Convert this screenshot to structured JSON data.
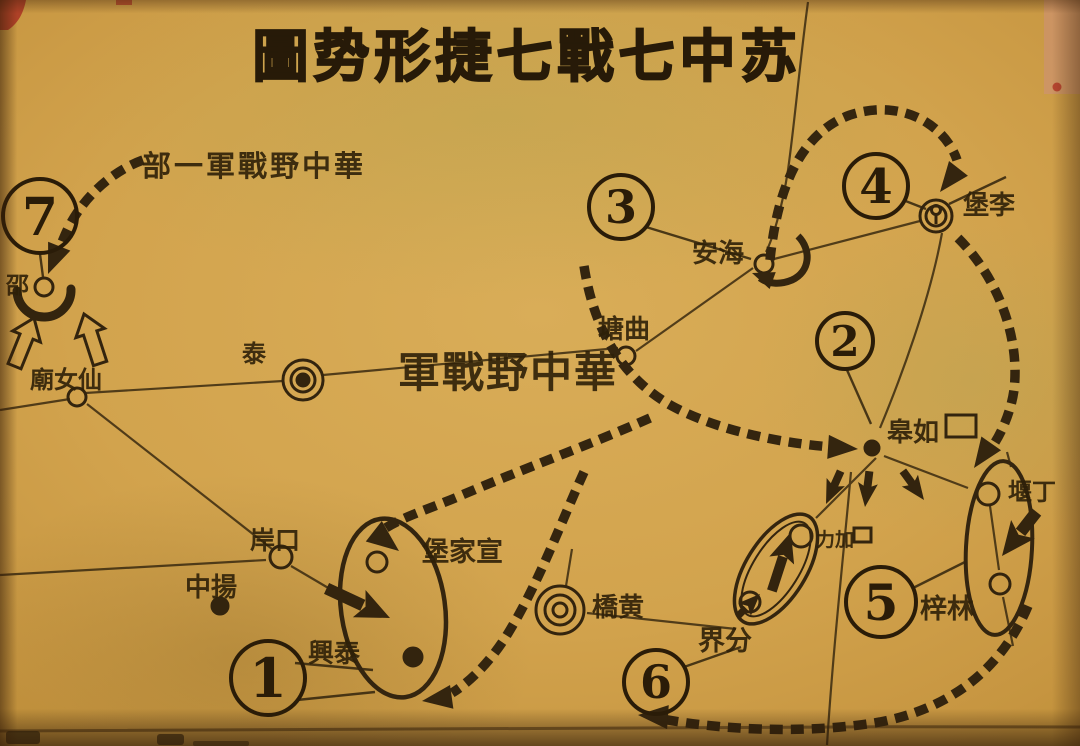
{
  "title": "圖势形捷七戰七中苏",
  "armies": {
    "hq": "軍戰野中華",
    "hq_detachment": "部一軍戰野中華"
  },
  "battles": [
    {
      "label": "1"
    },
    {
      "label": "2"
    },
    {
      "label": "3"
    },
    {
      "label": "4"
    },
    {
      "label": "5"
    },
    {
      "label": "6"
    },
    {
      "label": "7"
    }
  ],
  "places": {
    "shaobo": "邵",
    "xiannvmiao": "廟女仙",
    "taizhou": "泰",
    "qutang": "塘曲",
    "haian": "安海",
    "libao": "堡李",
    "rugao": "皋如",
    "dingyan": "堰丁",
    "linzi": "梓林",
    "jiali": "力加",
    "fenjie": "界分",
    "huangqiao": "橋黄",
    "kouan": "岸口",
    "yangzhong": "中揚",
    "xuanjiabao": "堡家宣",
    "taixing": "興泰"
  },
  "colors": {
    "paper": "#d0a14c",
    "ink": "#33240e",
    "red_mark": "#a93122"
  }
}
